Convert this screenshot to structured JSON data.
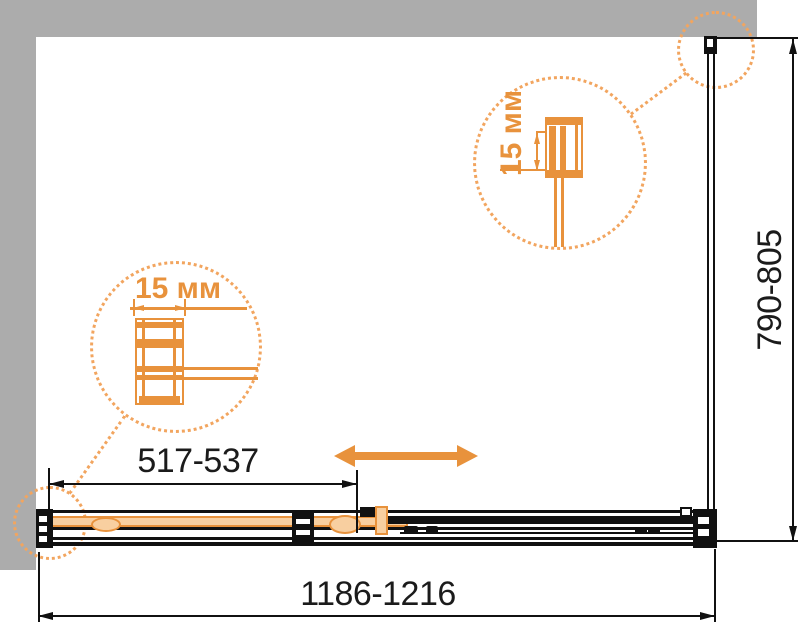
{
  "diagram": {
    "type": "shower-enclosure-installation-drawing",
    "dimensions": {
      "overall_width": "1186-1216",
      "side_depth": "790-805",
      "door_opening": "517-537"
    },
    "callouts": {
      "left_profile": {
        "label": "15 мм"
      },
      "top_profile": {
        "label": "15 мм"
      }
    },
    "icons": {
      "slide_direction": "double-headed-arrow",
      "detail_callout": "dotted-magnifier-circle"
    },
    "colors": {
      "accent_orange": "#e8923c",
      "accent_orange_pale": "#f8cfa0",
      "callout_dotted_orange": "#f2a55f",
      "wall_gray": "#acacac",
      "line_black": "#111111"
    }
  }
}
